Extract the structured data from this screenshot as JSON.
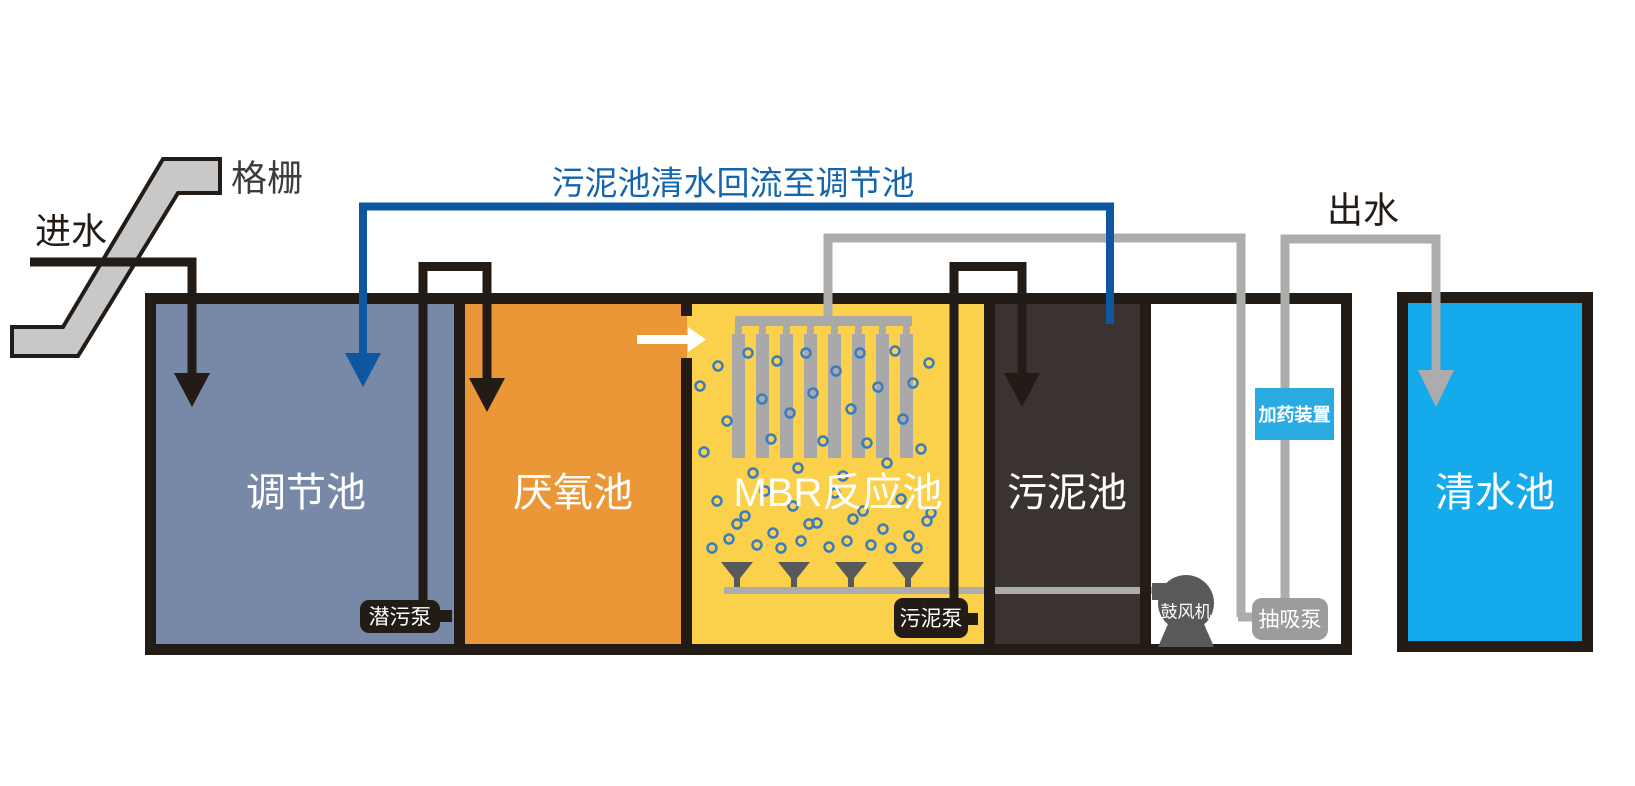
{
  "flow_labels": {
    "influent": "进水",
    "screen": "格栅",
    "effluent": "出水",
    "return_line": "污泥池清水回流至调节池"
  },
  "tanks": [
    {
      "id": "regulation",
      "label": "调节池",
      "color": "#7789a6"
    },
    {
      "id": "anaerobic",
      "label": "厌氧池",
      "color": "#eb9737"
    },
    {
      "id": "mbr",
      "label": "MBR反应池",
      "color": "#fbd04a"
    },
    {
      "id": "sludge",
      "label": "污泥池",
      "color": "#3a3331"
    },
    {
      "id": "clean_water",
      "label": "清水池",
      "color": "#15aaec"
    }
  ],
  "equipment": {
    "submersible_pump": "潜污泵",
    "sludge_pump": "污泥泵",
    "blower": "鼓风机",
    "suction_pump": "抽吸泵",
    "dosing_device": "加药装置"
  },
  "colors": {
    "outline_black": "#231b15",
    "pipe_gray": "#acacac",
    "screen_gray": "#c8c8c8",
    "blue_pipe": "#0e57a0",
    "blue_text": "#1465ae",
    "equipment_gray": "#58595b",
    "suction_gray": "#9c9c9e",
    "dosing_blue": "#29abe2",
    "bubble_blue": "#3b7cc0",
    "white": "#ffffff"
  },
  "membrane": {
    "count": 8,
    "x0": 732,
    "width": 13,
    "gap": 11,
    "top": 334,
    "bottom": 458,
    "stub_top": 326,
    "color": "#a9a9a9",
    "header": {
      "x": 735,
      "y": 316,
      "w": 177,
      "h": 10
    }
  },
  "diffusers": {
    "centers": [
      737,
      794,
      851,
      908
    ],
    "top": 562,
    "half": 16,
    "apex": 582,
    "stem_bottom": 592,
    "color": "#58595b"
  },
  "bubble_r": 4.5,
  "bubbles": [
    [
      700,
      386
    ],
    [
      704,
      452
    ],
    [
      718,
      366
    ],
    [
      727,
      421
    ],
    [
      748,
      353
    ],
    [
      753,
      473
    ],
    [
      762,
      399
    ],
    [
      771,
      439
    ],
    [
      777,
      361
    ],
    [
      790,
      413
    ],
    [
      798,
      468
    ],
    [
      806,
      353
    ],
    [
      813,
      393
    ],
    [
      823,
      441
    ],
    [
      836,
      371
    ],
    [
      843,
      476
    ],
    [
      851,
      409
    ],
    [
      860,
      353
    ],
    [
      867,
      443
    ],
    [
      878,
      387
    ],
    [
      887,
      463
    ],
    [
      895,
      351
    ],
    [
      903,
      419
    ],
    [
      913,
      383
    ],
    [
      921,
      449
    ],
    [
      929,
      363
    ],
    [
      931,
      513
    ],
    [
      712,
      548
    ],
    [
      717,
      501
    ],
    [
      729,
      539
    ],
    [
      737,
      524
    ],
    [
      745,
      516
    ],
    [
      757,
      545
    ],
    [
      765,
      491
    ],
    [
      773,
      533
    ],
    [
      781,
      548
    ],
    [
      793,
      506
    ],
    [
      801,
      541
    ],
    [
      809,
      524
    ],
    [
      817,
      523
    ],
    [
      829,
      547
    ],
    [
      835,
      493
    ],
    [
      847,
      541
    ],
    [
      853,
      519
    ],
    [
      863,
      511
    ],
    [
      871,
      545
    ],
    [
      883,
      529
    ],
    [
      891,
      548
    ],
    [
      901,
      499
    ],
    [
      909,
      536
    ],
    [
      917,
      548
    ],
    [
      927,
      521
    ]
  ]
}
